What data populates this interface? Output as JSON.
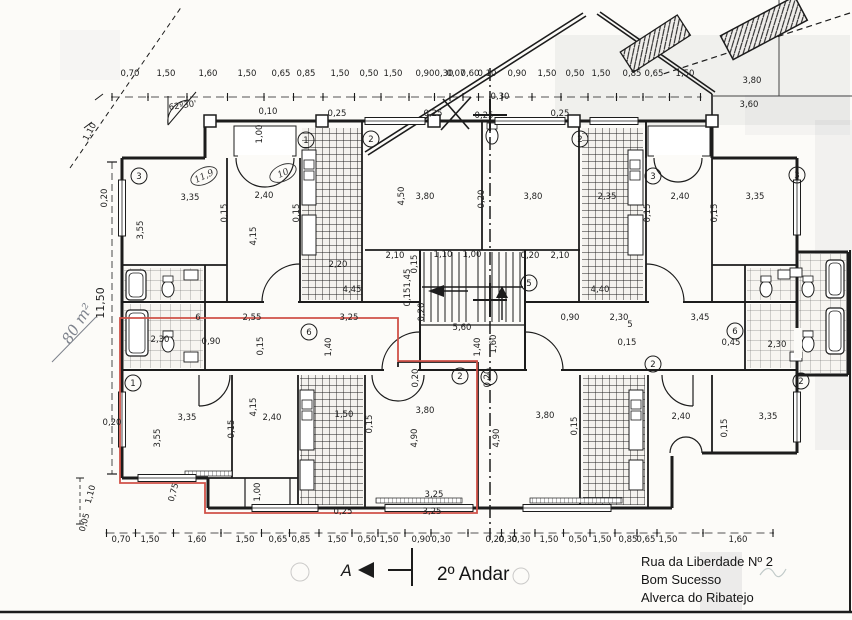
{
  "meta": {
    "title": "2º Andar",
    "address_lines": [
      "Rua da Liberdade Nº 2",
      "Bom Sucesso",
      "Alverca do Ribatejo"
    ]
  },
  "annotations": {
    "area_note": "80 m²",
    "overall_height": "11,50",
    "section_label": "A"
  },
  "colors": {
    "highlight_red": "#cf5148",
    "ink": "#1c1c1c",
    "pencil": "#7d828c",
    "paper": "#fcfbf8"
  },
  "dim_rows": {
    "top": {
      "y": 76,
      "labels": [
        [
          "0,70",
          130
        ],
        [
          "1,50",
          166
        ],
        [
          "1,60",
          208
        ],
        [
          "1,50",
          247
        ],
        [
          "0,65",
          281
        ],
        [
          "0,85",
          306
        ],
        [
          "1,50",
          340
        ],
        [
          "0,50",
          369
        ],
        [
          "1,50",
          393
        ],
        [
          "0,90",
          425
        ],
        [
          "0,30",
          444
        ],
        [
          "0,07",
          456
        ],
        [
          "0,60",
          470
        ],
        [
          "0,10",
          487
        ],
        [
          "0,90",
          517
        ],
        [
          "1,50",
          547
        ],
        [
          "0,50",
          575
        ],
        [
          "1,50",
          601
        ],
        [
          "0,85",
          632
        ],
        [
          "0,65",
          654
        ],
        [
          "1,50",
          685
        ]
      ]
    },
    "bottom": {
      "y": 542,
      "labels": [
        [
          "0,70",
          121
        ],
        [
          "1,50",
          150
        ],
        [
          "1,60",
          197
        ],
        [
          "1,50",
          245
        ],
        [
          "0,65",
          278
        ],
        [
          "0,85",
          301
        ],
        [
          "1,50",
          337
        ],
        [
          "0,50",
          367
        ],
        [
          "1,50",
          389
        ],
        [
          "0,90",
          421
        ],
        [
          "0,30",
          441
        ],
        [
          "0,20",
          495
        ],
        [
          "0,30",
          508
        ],
        [
          "0,30",
          521
        ],
        [
          "1,50",
          549
        ],
        [
          "0,50",
          578
        ],
        [
          "1,50",
          602
        ],
        [
          "0,85",
          628
        ],
        [
          "0,65",
          646
        ],
        [
          "1,50",
          668
        ],
        [
          "1,60",
          738
        ]
      ]
    }
  },
  "labels": [
    {
      "t": "0,10",
      "x": 268,
      "y": 114
    },
    {
      "t": "1,00",
      "x": 262,
      "y": 134,
      "r": -90
    },
    {
      "t": "0,25",
      "x": 337,
      "y": 116
    },
    {
      "t": "0,25",
      "x": 433,
      "y": 116
    },
    {
      "t": "0,25",
      "x": 560,
      "y": 116
    },
    {
      "t": "0,30",
      "x": 500,
      "y": 99
    },
    {
      "t": "0,25",
      "x": 484,
      "y": 118
    },
    {
      "t": "62º30'",
      "x": 183,
      "y": 108,
      "r": -8
    },
    {
      "t": "1,10",
      "x": 92,
      "y": 133,
      "r": -62
    },
    {
      "t": "3,80",
      "x": 752,
      "y": 83
    },
    {
      "t": "3,60",
      "x": 749,
      "y": 107
    },
    {
      "t": "3,35",
      "x": 190,
      "y": 200
    },
    {
      "t": "0,15",
      "x": 227,
      "y": 213,
      "r": -90
    },
    {
      "t": "2,40",
      "x": 264,
      "y": 198
    },
    {
      "t": "0,15",
      "x": 299,
      "y": 213,
      "r": -90
    },
    {
      "t": "3,55",
      "x": 143,
      "y": 230,
      "r": -90
    },
    {
      "t": "4,15",
      "x": 256,
      "y": 236,
      "r": -90
    },
    {
      "t": "2,20",
      "x": 338,
      "y": 267
    },
    {
      "t": "4,50",
      "x": 404,
      "y": 196,
      "r": -90
    },
    {
      "t": "3,80",
      "x": 425,
      "y": 199
    },
    {
      "t": "0,20",
      "x": 484,
      "y": 199,
      "r": -90
    },
    {
      "t": "3,80",
      "x": 533,
      "y": 199
    },
    {
      "t": "2,35",
      "x": 607,
      "y": 199
    },
    {
      "t": "0,15",
      "x": 650,
      "y": 213,
      "r": -90
    },
    {
      "t": "2,40",
      "x": 680,
      "y": 199
    },
    {
      "t": "0,15",
      "x": 717,
      "y": 213,
      "r": -90
    },
    {
      "t": "3,35",
      "x": 755,
      "y": 199
    },
    {
      "t": "2,10",
      "x": 395,
      "y": 258
    },
    {
      "t": "0,15",
      "x": 417,
      "y": 264,
      "r": -90
    },
    {
      "t": "1,10",
      "x": 443,
      "y": 257
    },
    {
      "t": "1,00",
      "x": 472,
      "y": 257
    },
    {
      "t": "0,20",
      "x": 530,
      "y": 258
    },
    {
      "t": "2,10",
      "x": 560,
      "y": 258
    },
    {
      "t": "4,45",
      "x": 352,
      "y": 292
    },
    {
      "t": "4,40",
      "x": 600,
      "y": 292
    },
    {
      "t": "6",
      "x": 198,
      "y": 320
    },
    {
      "t": "2,55",
      "x": 252,
      "y": 320
    },
    {
      "t": "0,90",
      "x": 211,
      "y": 344
    },
    {
      "t": "0,15",
      "x": 263,
      "y": 346,
      "r": -90
    },
    {
      "t": "2,30",
      "x": 160,
      "y": 342
    },
    {
      "t": "3,25",
      "x": 349,
      "y": 320
    },
    {
      "t": "1,40",
      "x": 331,
      "y": 347,
      "r": -90
    },
    {
      "t": "1,45",
      "x": 410,
      "y": 278,
      "r": -90
    },
    {
      "t": "0,15",
      "x": 410,
      "y": 297,
      "r": -90
    },
    {
      "t": "0,20",
      "x": 424,
      "y": 312,
      "r": -90
    },
    {
      "t": "5,60",
      "x": 462,
      "y": 330
    },
    {
      "t": "1,40",
      "x": 480,
      "y": 347,
      "r": -90
    },
    {
      "t": "1,60",
      "x": 496,
      "y": 344,
      "r": -90
    },
    {
      "t": "0,90",
      "x": 570,
      "y": 320
    },
    {
      "t": "2,30",
      "x": 619,
      "y": 320
    },
    {
      "t": "5",
      "x": 630,
      "y": 327
    },
    {
      "t": "3,45",
      "x": 700,
      "y": 320
    },
    {
      "t": "0,15",
      "x": 627,
      "y": 345
    },
    {
      "t": "0,45",
      "x": 731,
      "y": 345
    },
    {
      "t": "2,30",
      "x": 777,
      "y": 347
    },
    {
      "t": "0,20",
      "x": 418,
      "y": 378,
      "r": -90
    },
    {
      "t": "0,20",
      "x": 490,
      "y": 378,
      "r": -90
    },
    {
      "t": "3,35",
      "x": 187,
      "y": 420
    },
    {
      "t": "3,55",
      "x": 160,
      "y": 438,
      "r": -90
    },
    {
      "t": "0,15",
      "x": 234,
      "y": 429,
      "r": -90
    },
    {
      "t": "2,40",
      "x": 272,
      "y": 420
    },
    {
      "t": "4,15",
      "x": 256,
      "y": 407,
      "r": -90
    },
    {
      "t": "0,15",
      "x": 372,
      "y": 424,
      "r": -90
    },
    {
      "t": "1,50",
      "x": 344,
      "y": 417
    },
    {
      "t": "3,80",
      "x": 425,
      "y": 413
    },
    {
      "t": "4,90",
      "x": 417,
      "y": 438,
      "r": -90
    },
    {
      "t": "4,90",
      "x": 499,
      "y": 438,
      "r": -90
    },
    {
      "t": "3,80",
      "x": 545,
      "y": 418
    },
    {
      "t": "0,15",
      "x": 577,
      "y": 426,
      "r": -90
    },
    {
      "t": "2,40",
      "x": 681,
      "y": 419
    },
    {
      "t": "0,15",
      "x": 727,
      "y": 428,
      "r": -90
    },
    {
      "t": "3,35",
      "x": 768,
      "y": 419
    },
    {
      "t": "1,00",
      "x": 260,
      "y": 492,
      "r": -90
    },
    {
      "t": "0,75",
      "x": 176,
      "y": 493,
      "r": -75
    },
    {
      "t": "3,25",
      "x": 434,
      "y": 497
    },
    {
      "t": "0,25",
      "x": 343,
      "y": 514
    },
    {
      "t": "3,25",
      "x": 432,
      "y": 514
    },
    {
      "t": "0,20",
      "x": 107,
      "y": 198,
      "r": -90
    },
    {
      "t": "0,20",
      "x": 112,
      "y": 425
    },
    {
      "t": "1,10",
      "x": 93,
      "y": 495,
      "r": -75
    },
    {
      "t": "0,05",
      "x": 87,
      "y": 523,
      "r": -75
    }
  ],
  "room_numbers": [
    {
      "n": "3",
      "x": 139,
      "y": 176
    },
    {
      "n": "1",
      "x": 306,
      "y": 140
    },
    {
      "n": "2",
      "x": 371,
      "y": 139
    },
    {
      "n": "2",
      "x": 580,
      "y": 139
    },
    {
      "n": "3",
      "x": 653,
      "y": 176
    },
    {
      "n": "3",
      "x": 797,
      "y": 175
    },
    {
      "n": "5",
      "x": 529,
      "y": 283
    },
    {
      "n": "6",
      "x": 309,
      "y": 332
    },
    {
      "n": "6",
      "x": 735,
      "y": 331
    },
    {
      "n": "1",
      "x": 133,
      "y": 383
    },
    {
      "n": "2",
      "x": 460,
      "y": 376
    },
    {
      "n": "1",
      "x": 489,
      "y": 377
    },
    {
      "n": "2",
      "x": 653,
      "y": 364
    },
    {
      "n": "2",
      "x": 801,
      "y": 381
    }
  ],
  "area_ellipses": [
    {
      "t": "11,9",
      "x": 204,
      "y": 176
    },
    {
      "t": "10",
      "x": 283,
      "y": 173
    }
  ]
}
